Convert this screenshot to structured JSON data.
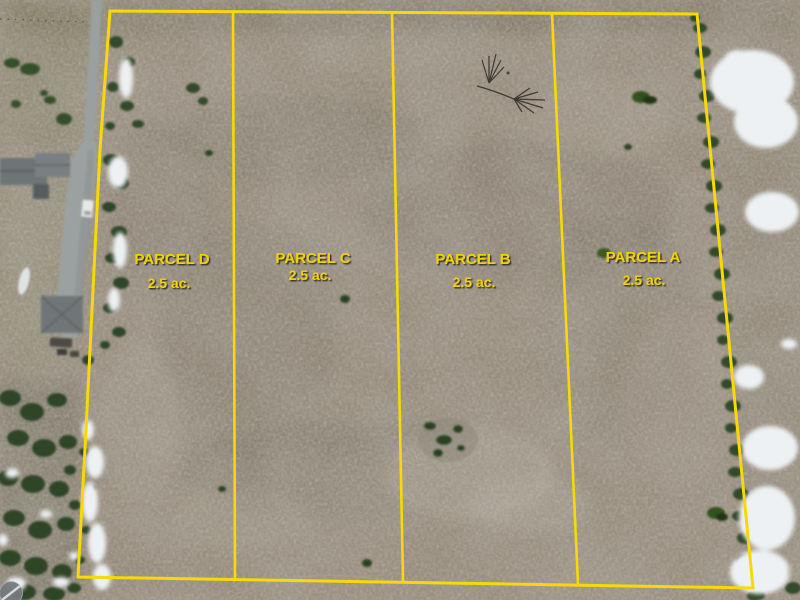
{
  "scene": {
    "description_label": "aerial-parcel-survey-photo",
    "parcels": [
      {
        "id": "D",
        "name": "PARCEL D",
        "acreage": "2.5 ac."
      },
      {
        "id": "C",
        "name": "PARCEL C",
        "acreage": "2.5 ac."
      },
      {
        "id": "B",
        "name": "PARCEL B",
        "acreage": "2.5 ac."
      },
      {
        "id": "A",
        "name": "PARCEL A",
        "acreage": "2.5 ac."
      }
    ],
    "colors": {
      "boundary": "#f6d907",
      "label_text": "#f0d206"
    },
    "icons": {
      "watermark": "drone-photo-watermark-icon"
    }
  }
}
